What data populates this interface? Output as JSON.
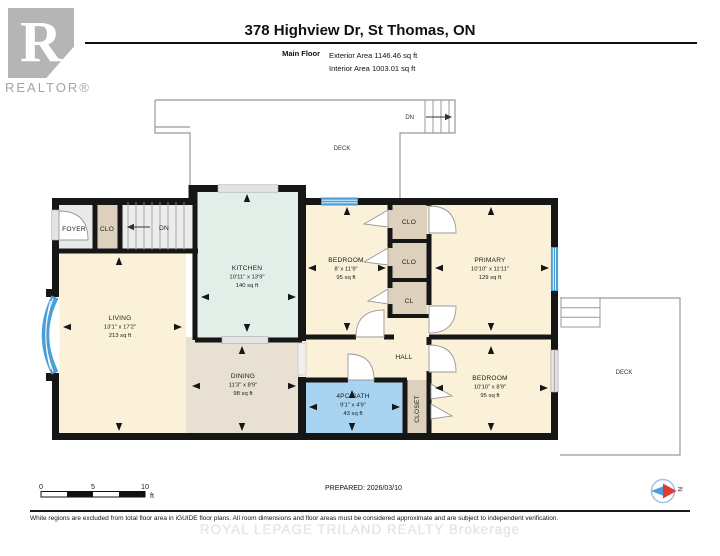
{
  "header": {
    "title": "378 Highview Dr, St Thomas, ON",
    "floor_label": "Main Floor",
    "exterior_area": "Exterior Area 1146.46 sq ft",
    "interior_area": "Interior Area 1003.01 sq ft",
    "logo_letter": "R",
    "logo_text": "REALTOR®"
  },
  "plan": {
    "deck_top": {
      "label": "DECK",
      "stairs_label": "DN"
    },
    "deck_right": {
      "label": "DECK"
    },
    "foyer": {
      "label": "FOYER"
    },
    "entry_closet": {
      "label": "CLO"
    },
    "stairs": {
      "label": "DN"
    },
    "living": {
      "label": "LIVING",
      "dims": "13'1\" x 17'2\"",
      "area": "213 sq ft"
    },
    "kitchen": {
      "label": "KITCHEN",
      "dims": "10'11\" x 13'9\"",
      "area": "140 sq ft"
    },
    "dining": {
      "label": "DINING",
      "dims": "11'3\" x 8'9\"",
      "area": "98 sq ft"
    },
    "bedroom_middle": {
      "label": "BEDROOM",
      "dims": "8' x 11'9\"",
      "area": "95 sq ft"
    },
    "closet_top": {
      "label": "CLO"
    },
    "closet_middle": {
      "label": "CLO"
    },
    "closet_small": {
      "label": "CL"
    },
    "primary": {
      "label": "PRIMARY",
      "dims": "10'10\" x 11'11\"",
      "area": "129 sq ft"
    },
    "hall": {
      "label": "HALL"
    },
    "bath": {
      "label": "4PC BATH",
      "dims": "9'1\" x 4'9\"",
      "area": "43 sq ft"
    },
    "hall_closet": {
      "label": "CLOSET"
    },
    "bedroom_right": {
      "label": "BEDROOM",
      "dims": "10'10\" x 8'9\"",
      "area": "95 sq ft"
    }
  },
  "footer": {
    "scale": {
      "zero": "0",
      "five": "5",
      "ten": "10",
      "unit": "ft"
    },
    "prepared": "PREPARED: 2026/03/10",
    "compass": "N",
    "disclaimer": "White regions are excluded from total floor area in iGUIDE floor plans. All room dimensions and floor areas must be considered approximate and are subject to independent verification.",
    "watermark": "ROYAL LEPAGE TRILAND REALTY Brokerage"
  },
  "colors": {
    "room_cream": "#faf1d8",
    "kitchen_mint": "#e2efe8",
    "dining_tan": "#e7e0d3",
    "bath_blue": "#a9d4f1",
    "closet_tan": "#ddd1bd",
    "gray_room": "#e9e9e9",
    "wall": "#161616",
    "window_blue": "#4a9fd8"
  }
}
